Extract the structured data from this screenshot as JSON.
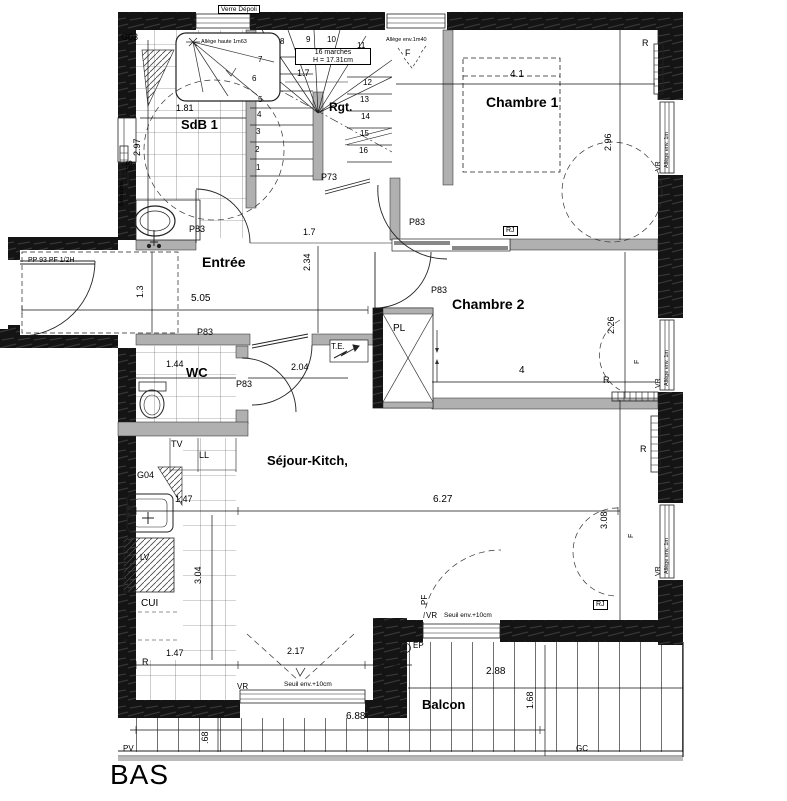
{
  "plan_title": "BAS",
  "rooms": {
    "sdb1": "SdB 1",
    "entree": "Entrée",
    "chambre1": "Chambre 1",
    "chambre2": "Chambre 2",
    "wc": "WC",
    "sejour_kitch": "Séjour-Kitch,",
    "cui": "CUI",
    "balcon": "Balcon",
    "rangement": "Rgt.",
    "placard": "PL"
  },
  "doors": {
    "p83": "P83",
    "p73": "P73",
    "entry": "PP 93 PF 1/2H"
  },
  "stairs": {
    "note1": "16 marches",
    "note2": "H = 17.31cm",
    "numbers": [
      "1",
      "2",
      "3",
      "4",
      "5",
      "6",
      "7",
      "8",
      "9",
      "10",
      "11",
      "12",
      "13",
      "14",
      "15",
      "16"
    ]
  },
  "windows": {
    "vr": "VR",
    "pf": "PF",
    "f": "F",
    "verre_depoli": "Verre Dépoli",
    "allege_haute": "Allège haute 1m63",
    "allege_1m": "Allège env. 1m",
    "allege_1m40": "Allège env.1m40",
    "seuil": "Seuil env.+10cm"
  },
  "equipment": {
    "r": "R",
    "ss": "SS",
    "tv": "TV",
    "ll": "LL",
    "lv": "LV",
    "te": "T.E.",
    "rj": "RJ",
    "ep": "EP",
    "pv": "PV",
    "gc": "GC",
    "g03": "G03",
    "g04": "G04",
    "banquette": "Banquette"
  },
  "dims": {
    "sdb_w": "1.81",
    "sdb_h": "2.97",
    "stair_w": "1.7",
    "c1_w": "4.1",
    "c1_h": "2.96",
    "entree_w": "5.05",
    "entree_h": "1.3",
    "hall_w": "1.7",
    "hall_h": "2.34",
    "c2_w": "4",
    "c2_h": "2.26",
    "wc_w": "1.44",
    "door_sejour": "2.04",
    "kitchen_w": "1.47",
    "kitchen_h": "3.04",
    "sejour_w": "6.27",
    "sejour_h": "3.08",
    "balcony_door": "2.17",
    "balcon_w": "6.88",
    "balcon_e": "2.88",
    "balcon_h": "1.68",
    "balcon_d": ".68"
  }
}
